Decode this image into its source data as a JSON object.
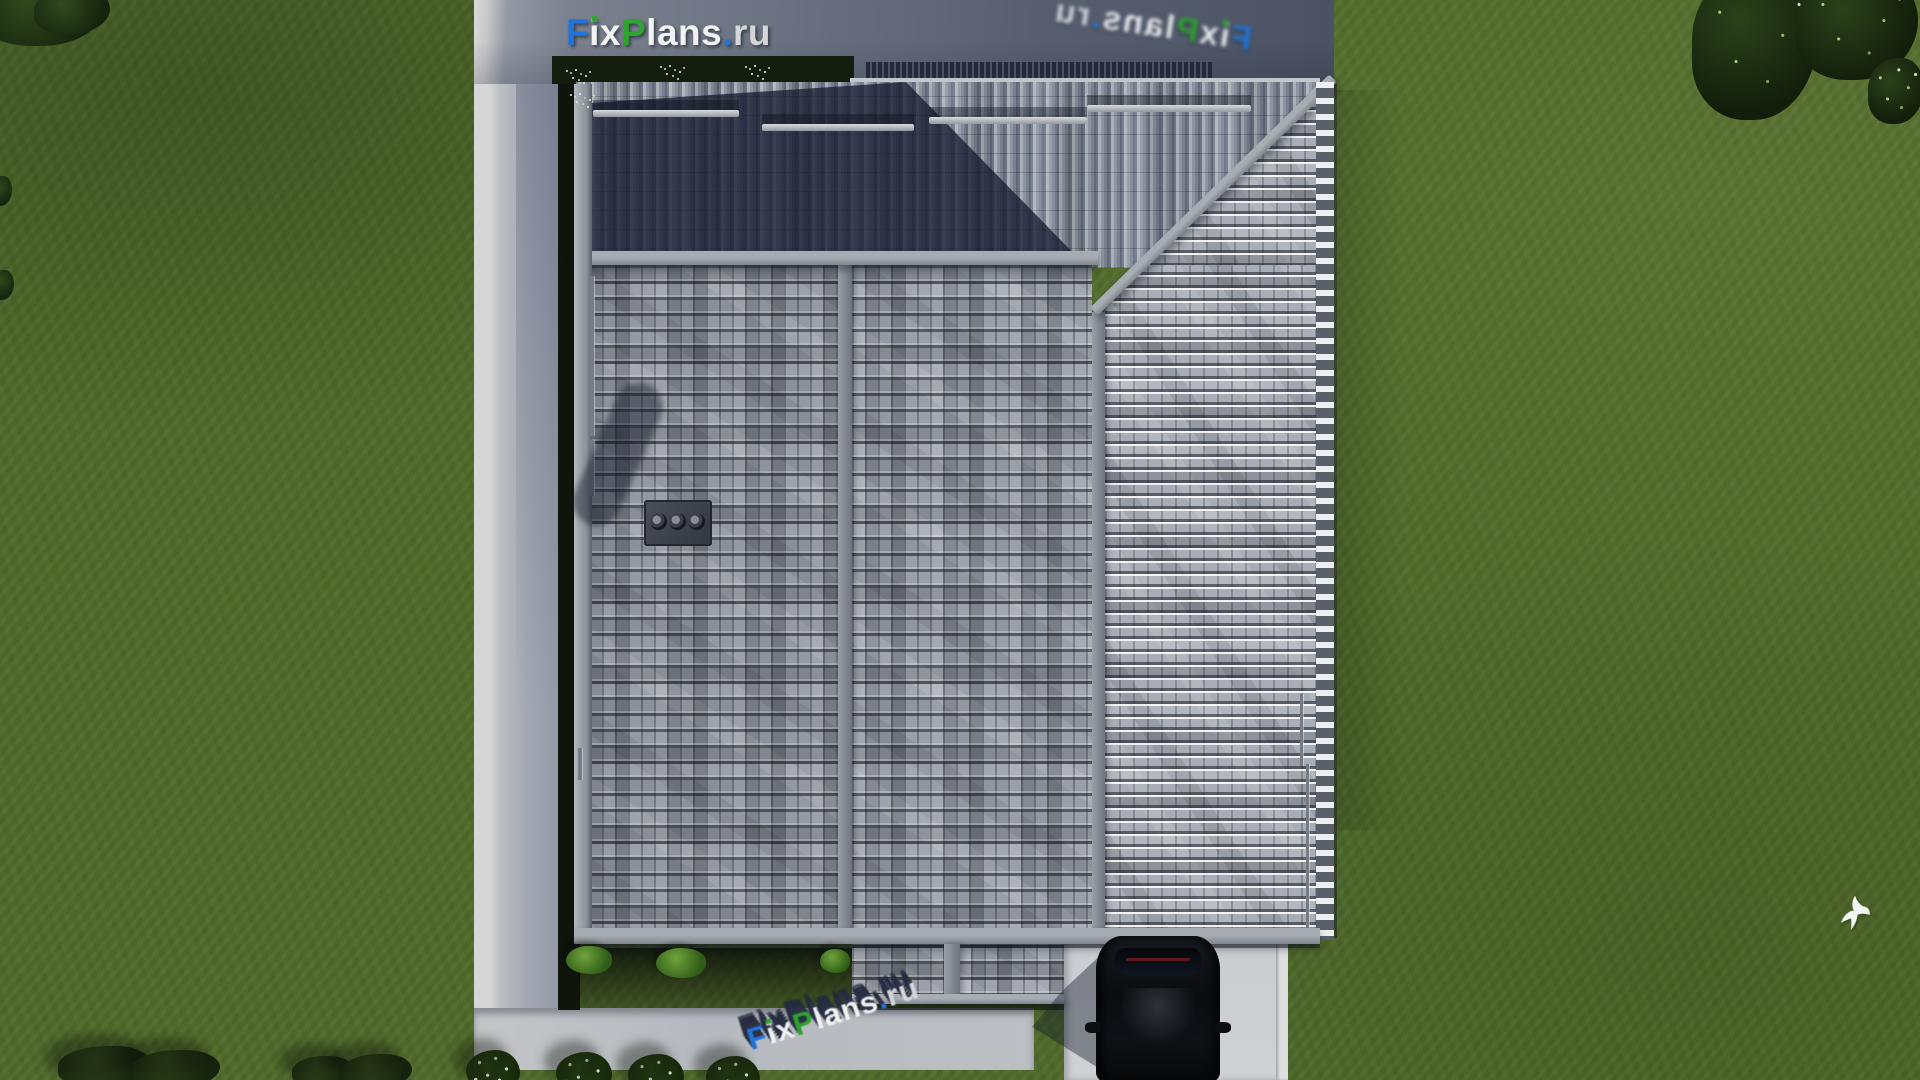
{
  "page": {
    "title": "FixPlans.ru — aerial top-down render of a house with gray tiled hip roof"
  },
  "brand": {
    "name": "FixPlans.ru",
    "segments": [
      {
        "text": "F",
        "color": "#1f74dc"
      },
      {
        "text": "i",
        "color": "#f0f2f4",
        "dot_color": "#2ea32e"
      },
      {
        "text": "x",
        "color": "#f0f2f4"
      },
      {
        "text": "P",
        "color": "#2ea32e"
      },
      {
        "text": "l",
        "color": "#f0f2f4"
      },
      {
        "text": "a",
        "color": "#f0f2f4"
      },
      {
        "text": "n",
        "color": "#f0f2f4"
      },
      {
        "text": "s",
        "color": "#f0f2f4"
      },
      {
        "text": ".",
        "color": "#1f74dc"
      },
      {
        "text": "r",
        "color": "#d4d6da"
      },
      {
        "text": "u",
        "color": "#d4d6da"
      }
    ]
  },
  "watermarks": {
    "top_left": {
      "text": "FixPlans.ru",
      "style": "flat logo on driveway, top-left"
    },
    "top_right": {
      "text": "FixPlans.ru",
      "style": "mirrored blurred logo lying on driveway, top-right"
    },
    "bottom": {
      "text": "FixPlans.ru",
      "style": "extruded 3D logo lying on walkway, bottom-center, rotated"
    }
  },
  "scene": {
    "description": "Top-down 3D architectural render: house with gray tiled hip roof, chimney with three flues, asphalt driveway at top, L-shaped concrete walkway, black car parked on a pad at bottom right, lawn with trees and flowering shrubs, white bird flying over grass",
    "chimney_flues": 3,
    "colors": {
      "grass": "#4f692b",
      "asphalt_driveway": "#5a6272",
      "walkway": "#b9bcc1",
      "car_pad": "#cdd0d3",
      "roof_light": "#9aa0aa",
      "roof_east_slope": "#a9aeb6",
      "roof_shadow": "#2e3850",
      "ridge": "#8f939a",
      "car": "#0b0d11",
      "tree_dark": "#16240e",
      "leaf_highlight": "#a5c87b"
    }
  }
}
